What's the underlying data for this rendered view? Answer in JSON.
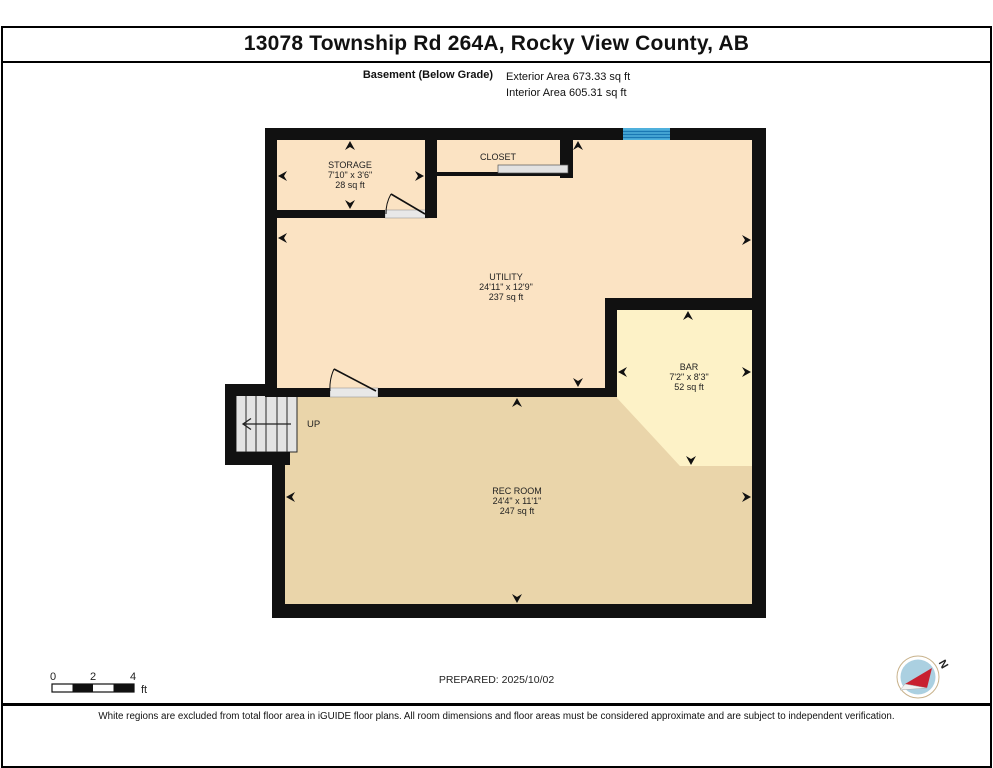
{
  "header": {
    "title": "13078 Township Rd 264A, Rocky View County, AB",
    "floor_label": "Basement (Below Grade)",
    "exterior_area": "Exterior Area 673.33 sq ft",
    "interior_area": "Interior Area 605.31 sq ft"
  },
  "rooms": {
    "storage": {
      "name": "STORAGE",
      "dims": "7'10\" x 3'6\"",
      "area": "28 sq ft"
    },
    "closet": {
      "name": "CLOSET"
    },
    "utility": {
      "name": "UTILITY",
      "dims": "24'11\" x 12'9\"",
      "area": "237 sq ft"
    },
    "bar": {
      "name": "BAR",
      "dims": "7'2\" x 8'3\"",
      "area": "52 sq ft"
    },
    "rec_room": {
      "name": "REC ROOM",
      "dims": "24'4\" x 11'1\"",
      "area": "247 sq ft"
    },
    "stairs": {
      "label": "UP"
    }
  },
  "scale_bar": {
    "tick0": "0",
    "tick2": "2",
    "tick4": "4",
    "unit": "ft"
  },
  "footer": {
    "prepared": "PREPARED: 2025/10/02",
    "disclaimer": "White regions are excluded from total floor area in iGUIDE floor plans. All room dimensions and floor areas must be considered approximate and are subject to independent verification."
  },
  "compass": {
    "north_label": "N"
  },
  "colors": {
    "wall": "#111111",
    "floor_peach": "#fbe3c3",
    "floor_tan": "#ead5aa",
    "floor_yellow": "#fdf2c7",
    "stair_gray": "#e4e4e4",
    "threshold_gray": "#e8e8e8",
    "window_blue": "#4fb0dc",
    "window_stripe": "#1a78b4",
    "compass_red": "#c8202f",
    "compass_blue": "#abd0e1"
  }
}
